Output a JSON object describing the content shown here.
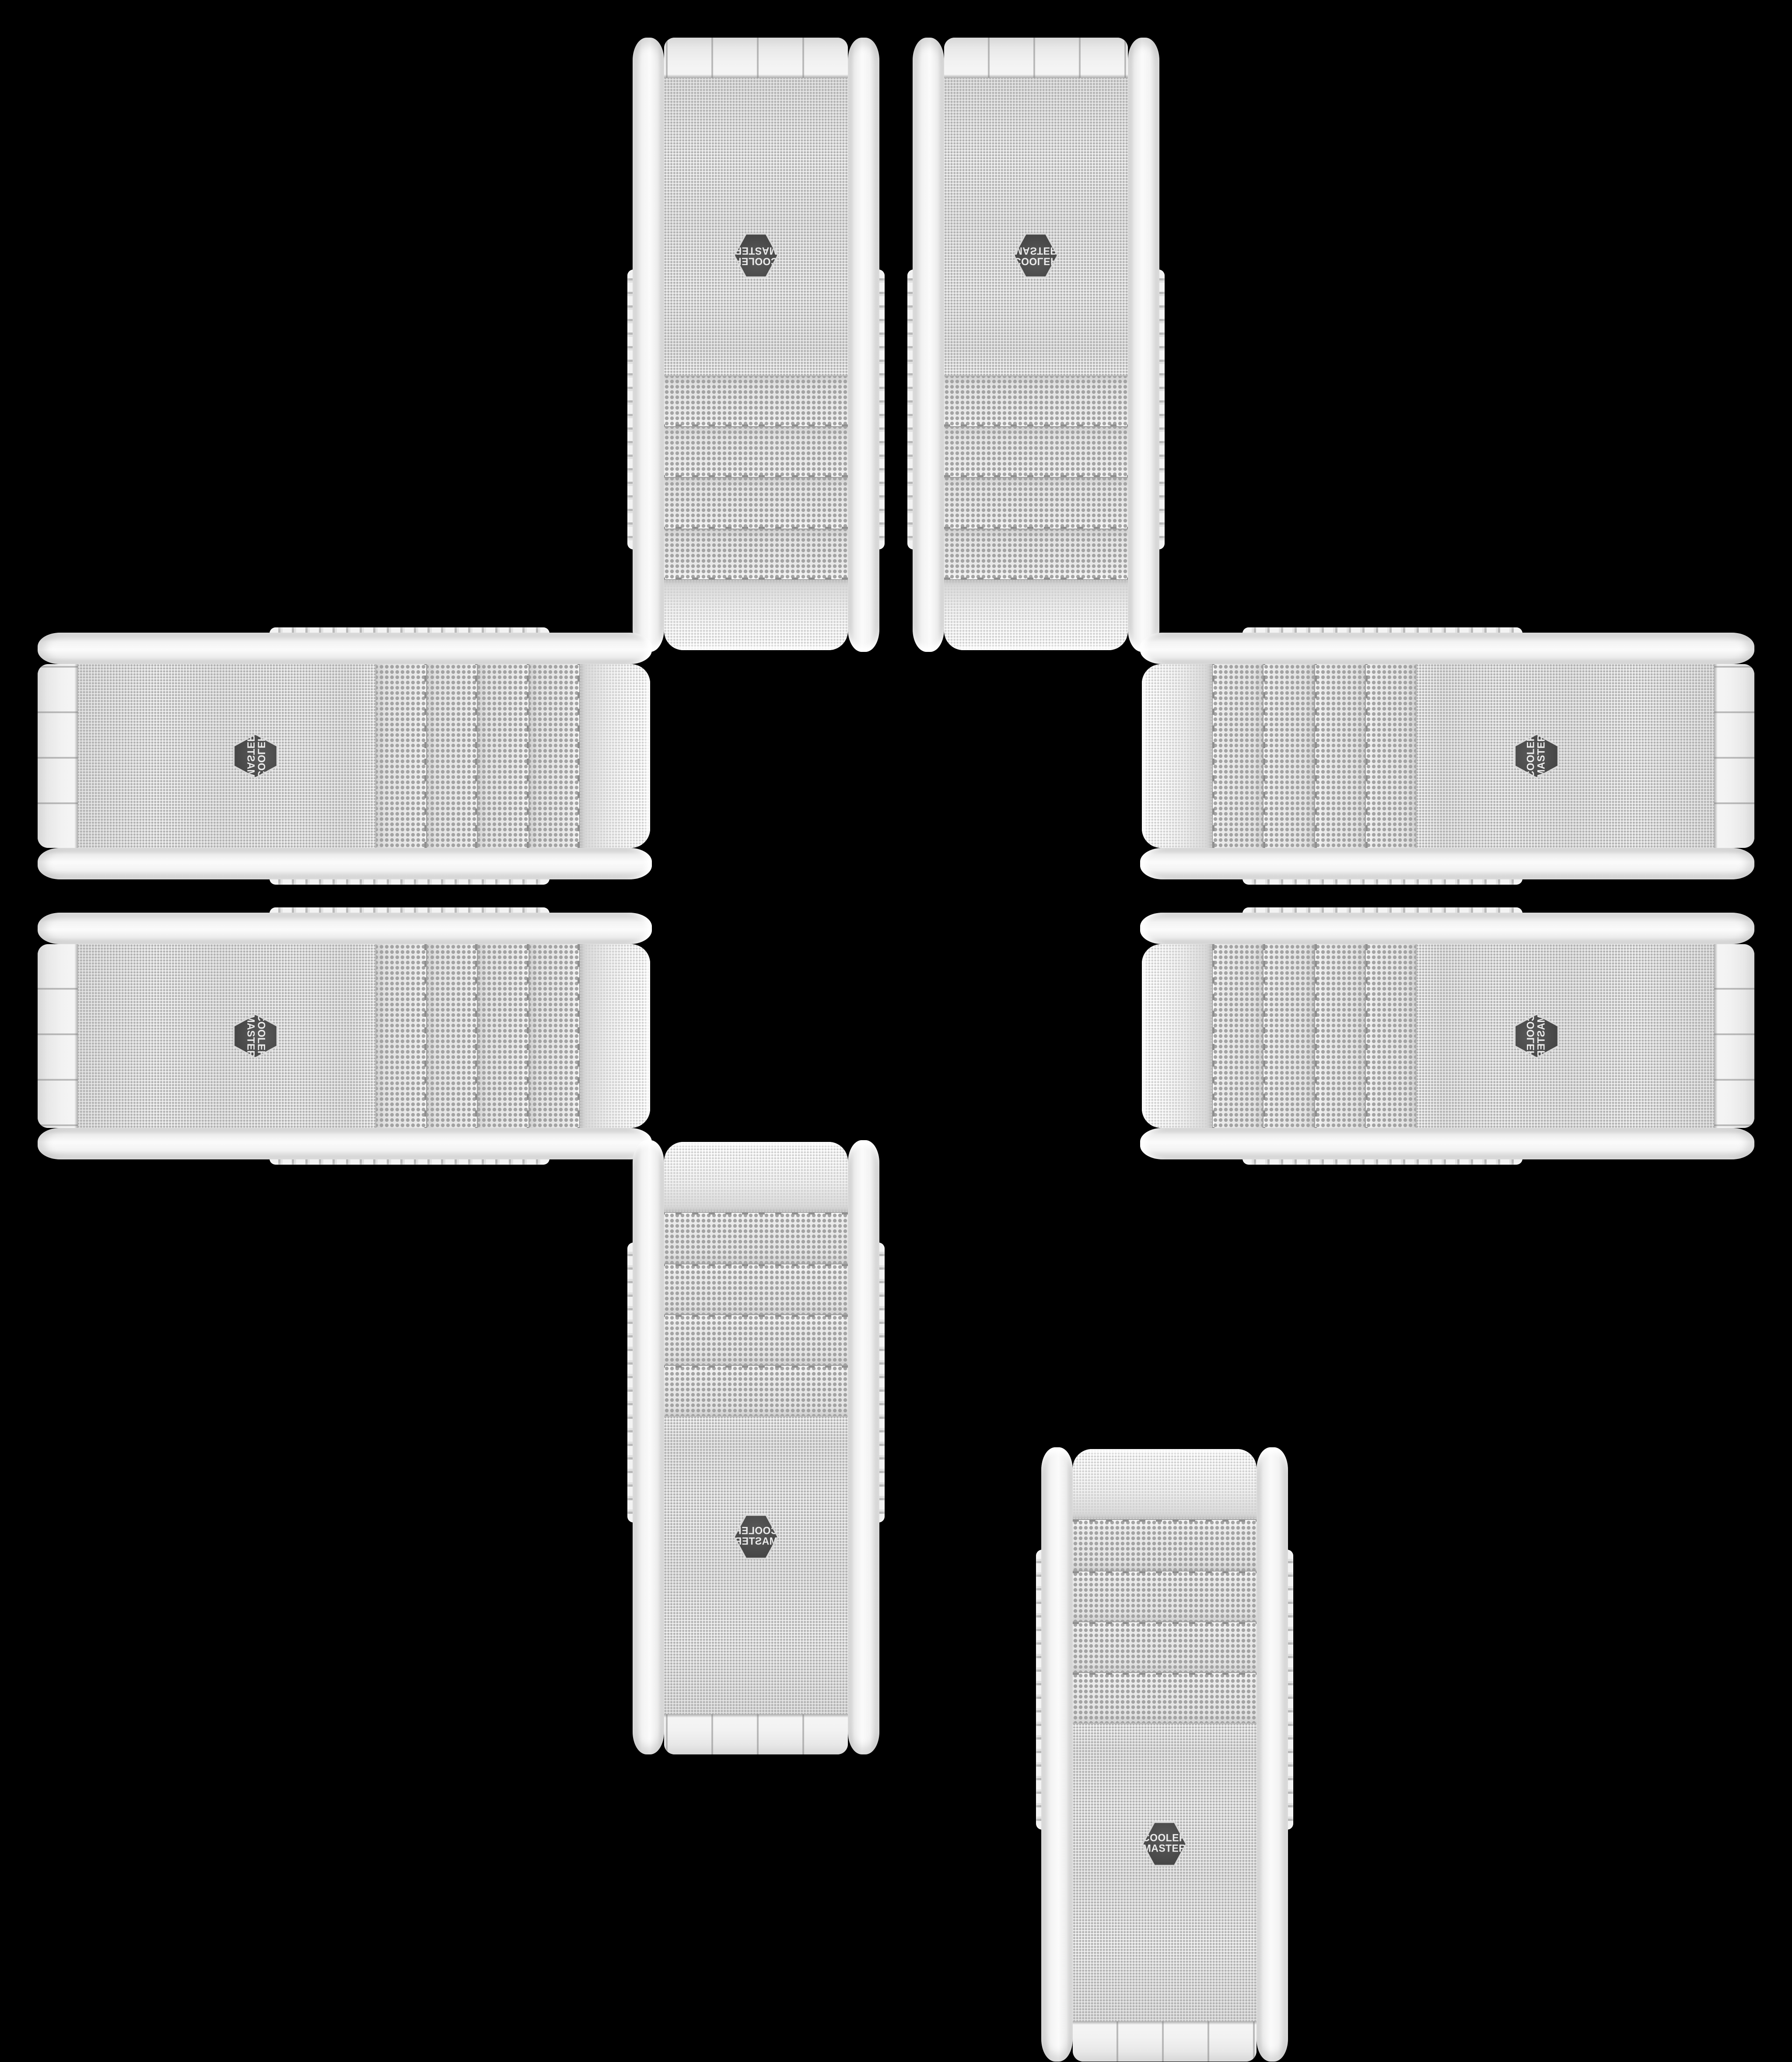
{
  "scene": {
    "background": "#000000",
    "stage_size": 2048,
    "layout": "eight identical white PC tower cases arranged in a plus / cross pattern on black"
  },
  "product": {
    "brand_badge": {
      "line1": "COOLER",
      "line2": "MASTER"
    },
    "bay_covers": 4,
    "colors": {
      "background": "#000000",
      "rail": "#f3f3f3",
      "mesh_dot": "#b3b3b3",
      "bay_dot": "#a3a3a3",
      "shoulder_dot": "#d2d2d2",
      "cap": "#f2f2f2",
      "seam": "#8f8f8f",
      "badge_bg": "#474747",
      "badge_text": "#ebebeb",
      "badge_bezel": "#d8d8d8"
    }
  },
  "instances": [
    {
      "id": "top-left",
      "cx": 864.25,
      "cy": 393.75,
      "transform": "rotate(180deg)"
    },
    {
      "id": "top-right",
      "cx": 1183.75,
      "cy": 393.75,
      "transform": "scaleY(-1)"
    },
    {
      "id": "left-top",
      "cx": 393.75,
      "cy": 864.25,
      "transform": "scaleX(-1) rotate(-90deg)"
    },
    {
      "id": "left-bottom",
      "cx": 393.75,
      "cy": 1183.75,
      "transform": "rotate(90deg)"
    },
    {
      "id": "right-top",
      "cx": 1654.25,
      "cy": 864.25,
      "transform": "rotate(-90deg)"
    },
    {
      "id": "right-bottom",
      "cx": 1654.25,
      "cy": 1183.75,
      "transform": "scaleY(-1) rotate(-90deg)"
    },
    {
      "id": "bottom-left",
      "cx": 864.25,
      "cy": 1654.25,
      "transform": "scaleX(-1)"
    },
    {
      "id": "bottom-right",
      "cx": 1183.75,
      "cy": 1654.25,
      "transform": "none"
    }
  ]
}
